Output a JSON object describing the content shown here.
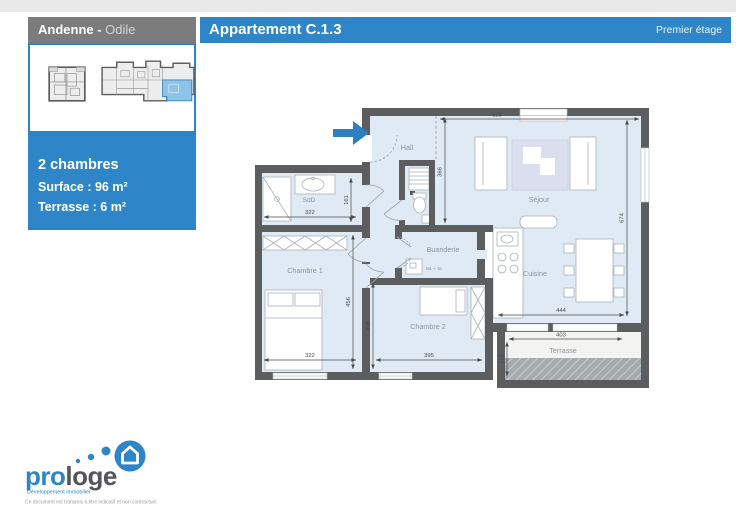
{
  "header": {
    "location_bold": "Andenne - ",
    "location_light": "Odile",
    "title": "Appartement C.1.3",
    "floor": "Premier étage"
  },
  "sidebar": {
    "line1": "2 chambres",
    "line2": "Surface : 96 m²",
    "line3": "Terrasse : 6 m²"
  },
  "plan": {
    "rooms": {
      "hall": "Hall",
      "sdd": "SdD",
      "chambre1": "Chambre 1",
      "chambre2": "Chambre 2",
      "buanderie": "Buanderie",
      "sejour": "Séjour",
      "cuisine": "Cuisine",
      "terrasse": "Terrasse"
    },
    "dims": {
      "d628": "628",
      "d366": "366",
      "d322_sdd": "322",
      "d161": "161",
      "d322_ch1": "322",
      "d456": "456",
      "d208": "208",
      "d395": "395",
      "d674": "674",
      "d444": "444",
      "d403": "403",
      "d162": "162"
    },
    "washer_note": "ML + SL"
  },
  "logo": {
    "pro": "pro",
    "loge": "loge",
    "tagline": "Développement immobilier",
    "disclaimer": "Ce document est transmis à titre indicatif et non contractuel"
  },
  "colors": {
    "accent": "#2e86c9",
    "header_gray": "#7c7c7c",
    "wall": "#5b5d5f",
    "floor": "#dfeaf4",
    "plan_highlight": "#8cc3e8"
  }
}
